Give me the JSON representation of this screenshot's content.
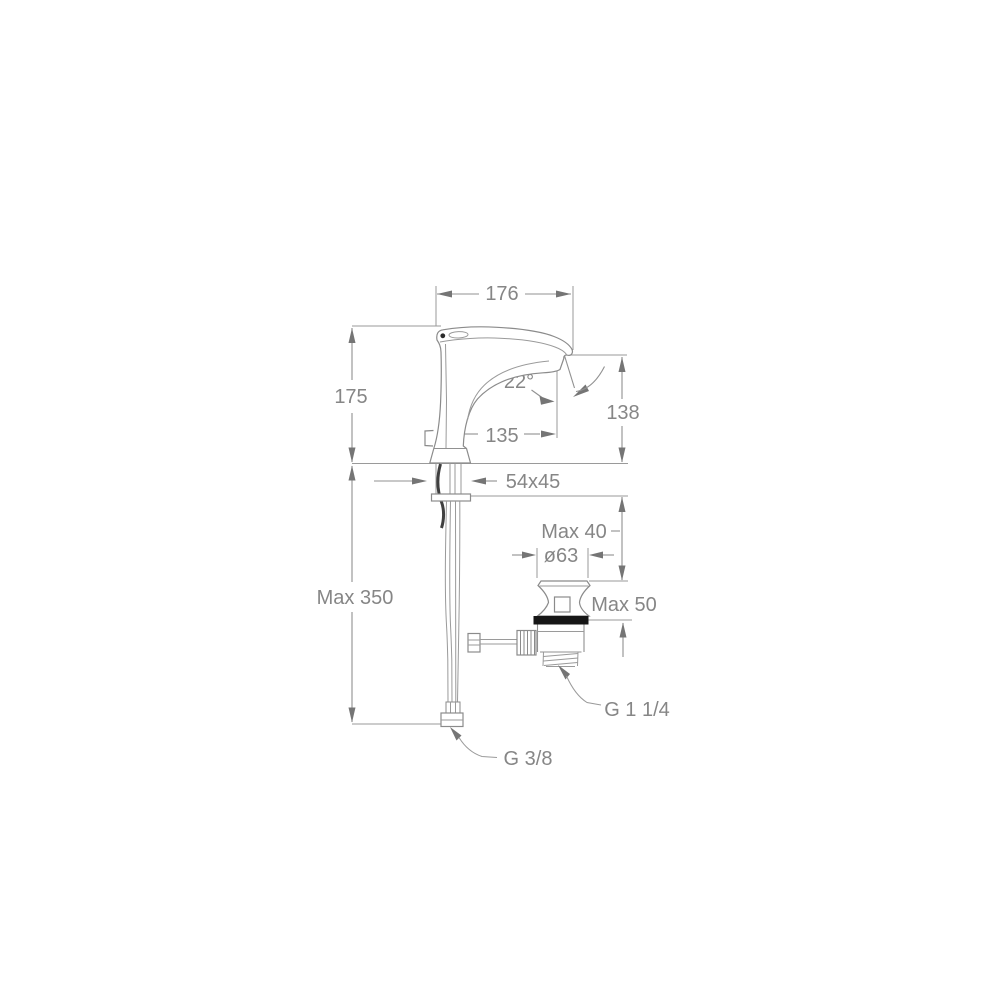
{
  "drawing": {
    "subject": "basin-mixer-faucet-dimension-drawing",
    "colors": {
      "background": "#ffffff",
      "line": "#919191",
      "text": "#868686",
      "arrow": "#757575",
      "gasket": "#161616"
    },
    "dimensions": {
      "spout_width": "176",
      "body_height": "175",
      "spout_angle": "22°",
      "outlet_height": "138",
      "spout_reach": "135",
      "base_size": "54x45",
      "max_top": "Max 40",
      "drain_diameter": "ø63",
      "max_bottom": "Max 50",
      "hose_length": "Max 350",
      "drain_thread": "G 1 1/4",
      "supply_thread": "G 3/8"
    }
  }
}
